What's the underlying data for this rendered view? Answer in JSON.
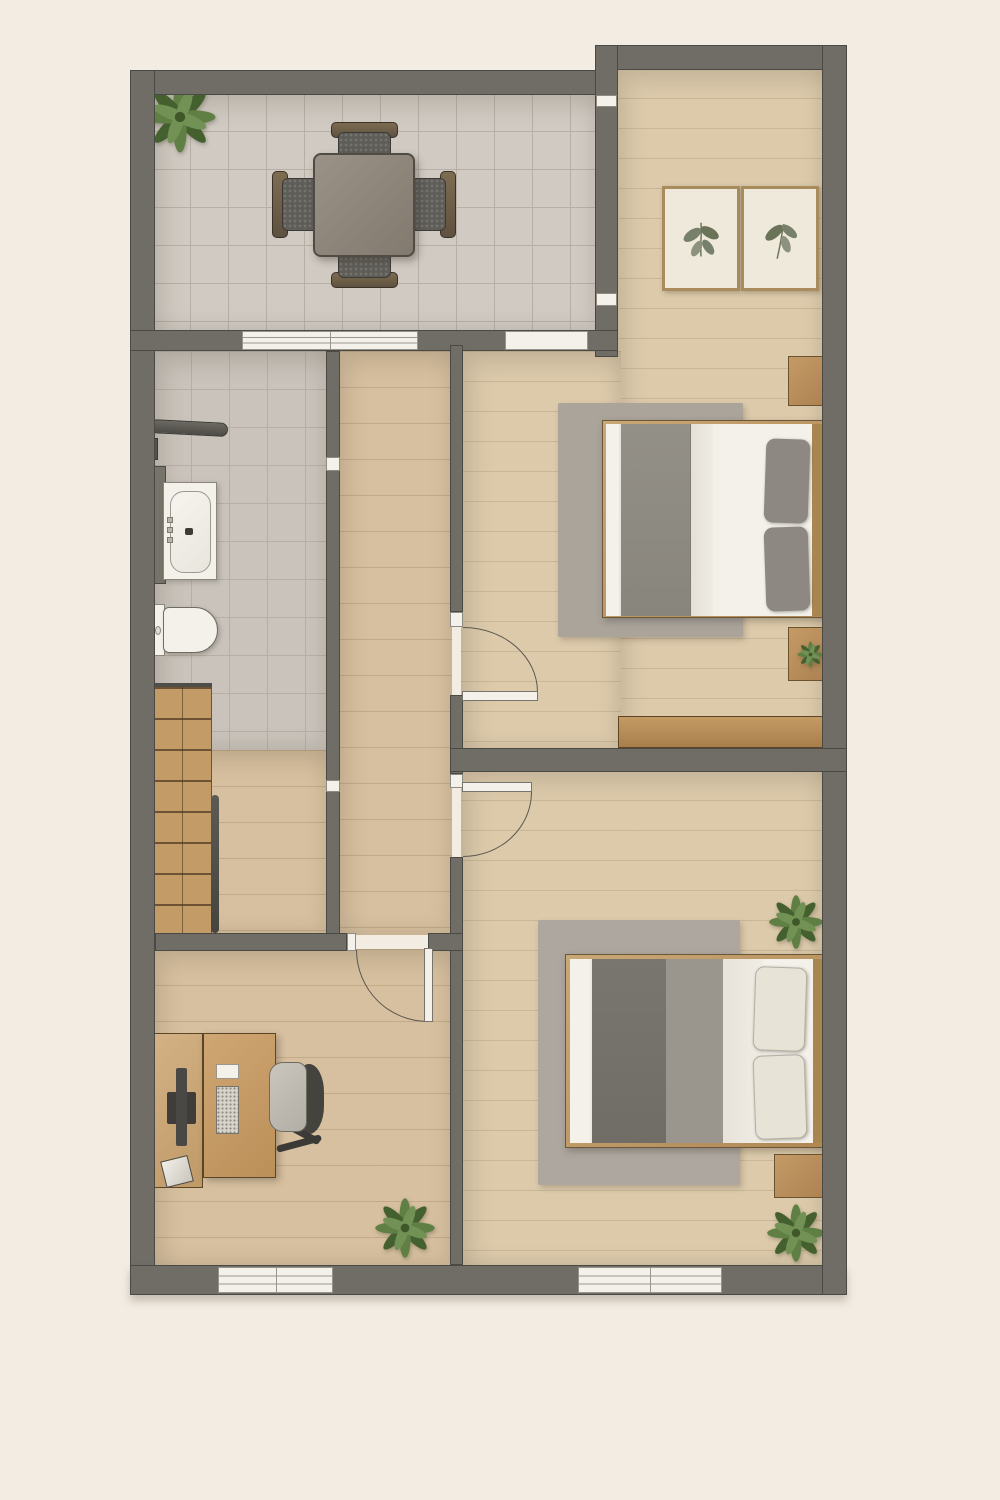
{
  "scene": "top-down architectural floor plan rendering, no text labels",
  "palette": {
    "bg": "#f2ece3",
    "wall": "#6f6d66",
    "wallEdge": "#4b4944",
    "arcLine": "#5b584f",
    "tileTerrace": "#d0cac2",
    "tileBath": "#c9c3bb",
    "tileLine": "#b7afa5",
    "wood": "#d7c09f",
    "woodBedroom": "#dccaab",
    "stairWood": "#c29b66",
    "stairLine": "#6d5334",
    "white": "#f3f1ea",
    "rug": "#aba49b",
    "cushion": "#5f5d58",
    "artFrame": "#a98c5e",
    "artBg": "#efe9db",
    "green": "#5f7f44",
    "greenDark": "#45602f"
  },
  "rooms": [
    {
      "name": "terrace-dining",
      "floor": "tile",
      "contents": [
        "square-dining-table",
        "four-chairs",
        "potted-plant"
      ]
    },
    {
      "name": "bedroom-top",
      "floor": "wood",
      "contents": [
        "double-bed",
        "two-gray-pillows",
        "area-rug",
        "nightstand-with-lamp",
        "nightstand-with-plant",
        "two-framed-botanical-prints",
        "low-wood-bench"
      ]
    },
    {
      "name": "bathroom",
      "floor": "tile",
      "contents": [
        "bathtub",
        "toilet",
        "shower-rail"
      ]
    },
    {
      "name": "staircase",
      "floor": "wood",
      "contents": [
        "eight-steps",
        "handrail"
      ]
    },
    {
      "name": "hallway",
      "floor": "wood",
      "contents": []
    },
    {
      "name": "office",
      "floor": "wood",
      "contents": [
        "desk",
        "sideboard",
        "monitor",
        "keyboard",
        "paper-sheet",
        "paper-tray",
        "office-chair",
        "potted-plant"
      ]
    },
    {
      "name": "bedroom-bottom",
      "floor": "wood",
      "contents": [
        "double-bed",
        "two-cream-pillows",
        "area-rug",
        "nightstand-with-lamp",
        "two-potted-plants"
      ]
    }
  ],
  "openings": {
    "windows": [
      "terrace-sliding-window",
      "terrace-bedroom-slider",
      "office-bottom-window",
      "bedroom-bottom-window"
    ],
    "doors": [
      "bedroom-top-door",
      "bedroom-bottom-door",
      "office-door"
    ]
  }
}
